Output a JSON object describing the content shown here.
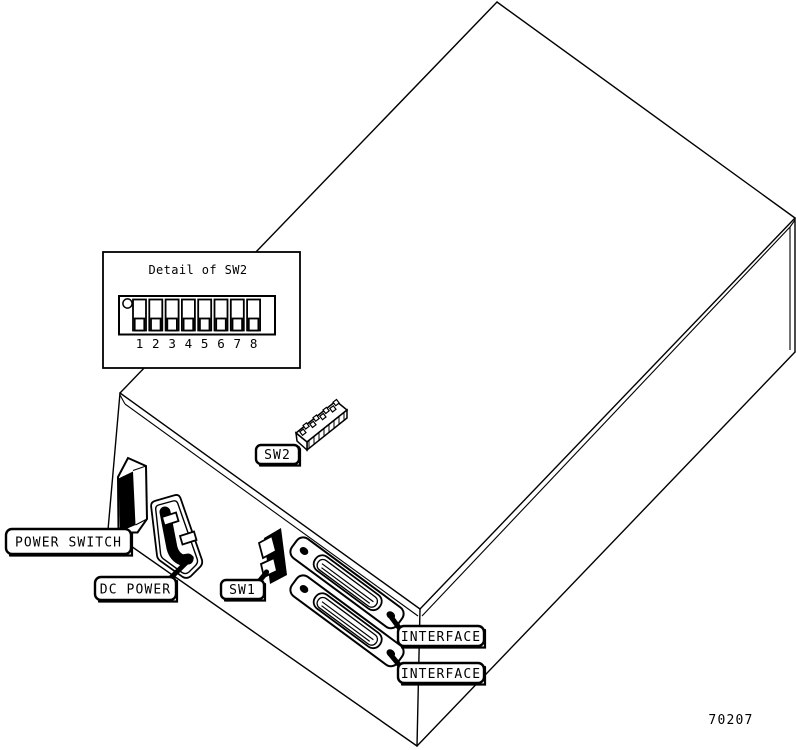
{
  "figure": {
    "number": "70207"
  },
  "detail_box": {
    "title": "Detail of SW2",
    "switch_numbers": [
      "1",
      "2",
      "3",
      "4",
      "5",
      "6",
      "7",
      "8"
    ]
  },
  "labels": {
    "power_switch": "POWER SWITCH",
    "dc_power": "DC POWER",
    "sw1": "SW1",
    "sw2": "SW2",
    "interface_top": "INTERFACE",
    "interface_bottom": "INTERFACE"
  },
  "colors": {
    "line": "#000000",
    "background": "#ffffff"
  }
}
